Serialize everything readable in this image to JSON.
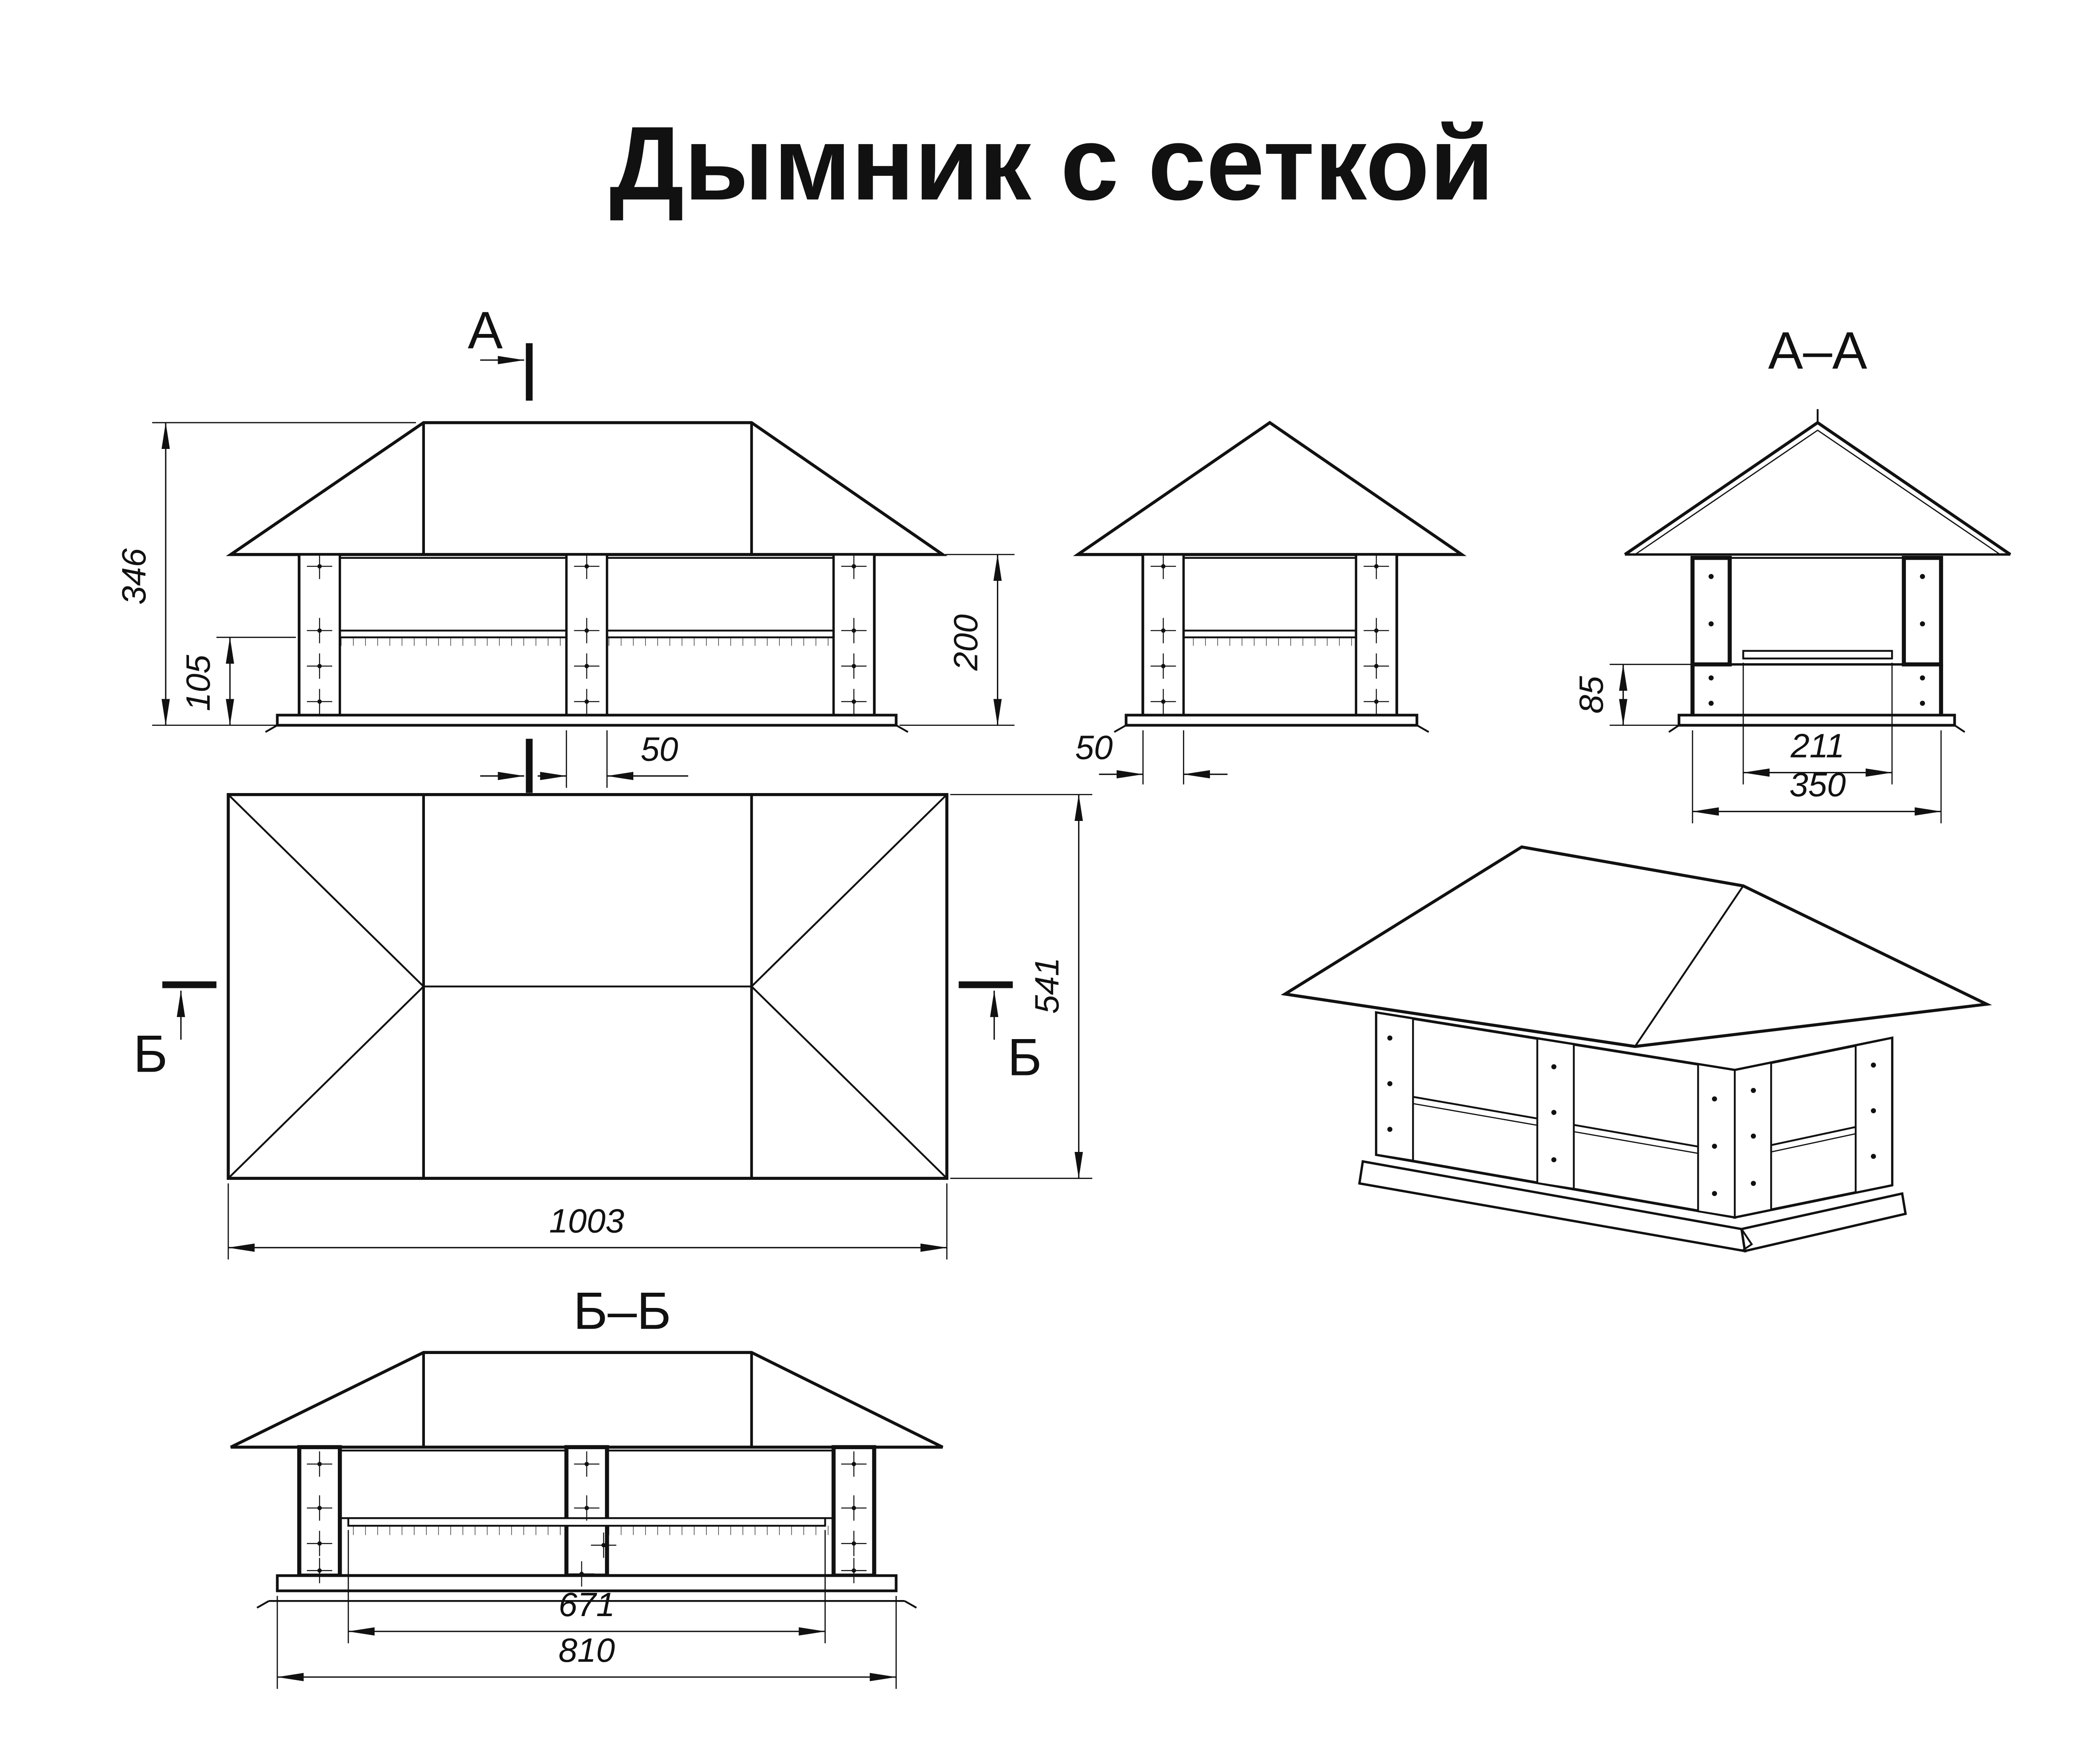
{
  "title": "Дымник с сеткой",
  "colors": {
    "ink": "#111111",
    "background": "#ffffff"
  },
  "front_view": {
    "section_letter": "А",
    "total_height": "346",
    "skirt_height": "105",
    "post_width": "50",
    "body_height": "200"
  },
  "side_view": {
    "post_width": "50"
  },
  "section_aa": {
    "label": "А–А",
    "skirt_height": "85",
    "inner_width": "211",
    "base_width": "350"
  },
  "plan_view": {
    "section_letter": "Б",
    "length": "1003",
    "width": "541"
  },
  "section_bb": {
    "label": "Б–Б",
    "liner_length": "671",
    "base_length": "810"
  }
}
